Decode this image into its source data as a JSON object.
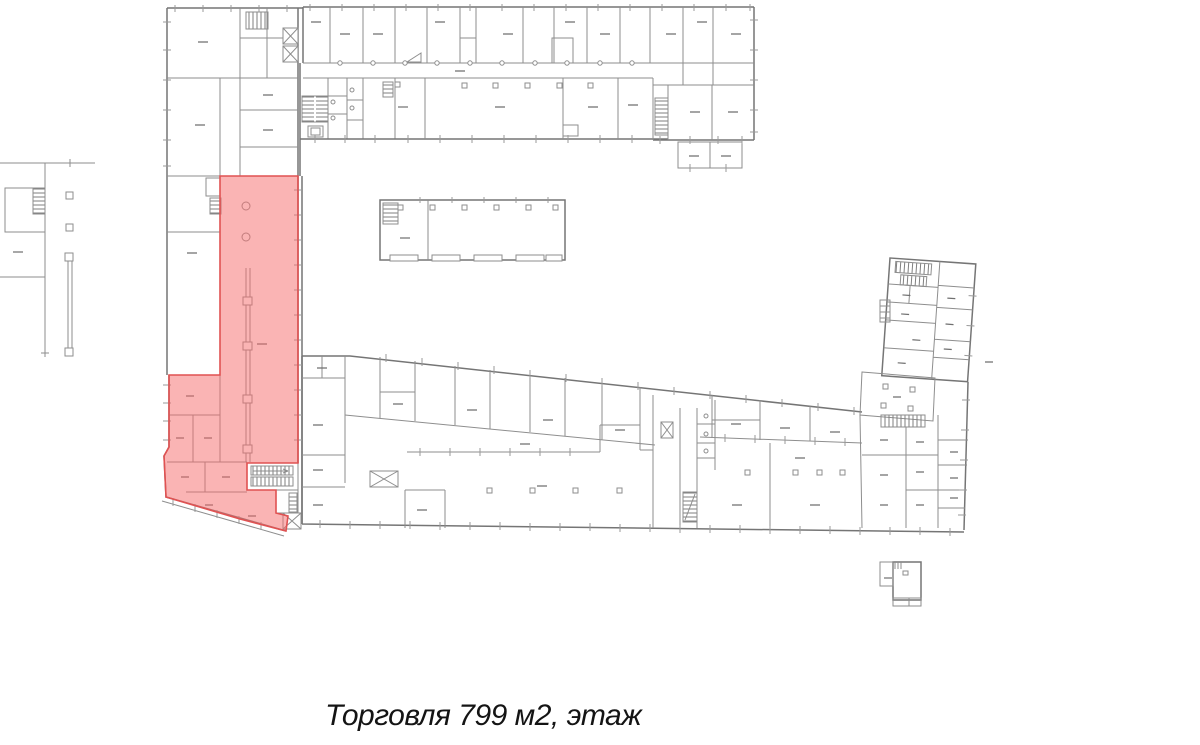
{
  "caption": {
    "text": "Торговля 799 м2, этаж"
  },
  "highlight": {
    "label": "Торговля",
    "area_m2": "799",
    "fill": "#f56a6a",
    "fill_opacity": "0.5",
    "stroke": "#e05252"
  },
  "plan": {
    "line_color": "#8e8e8e",
    "exterior_line_color": "#757575",
    "background": "#ffffff"
  }
}
